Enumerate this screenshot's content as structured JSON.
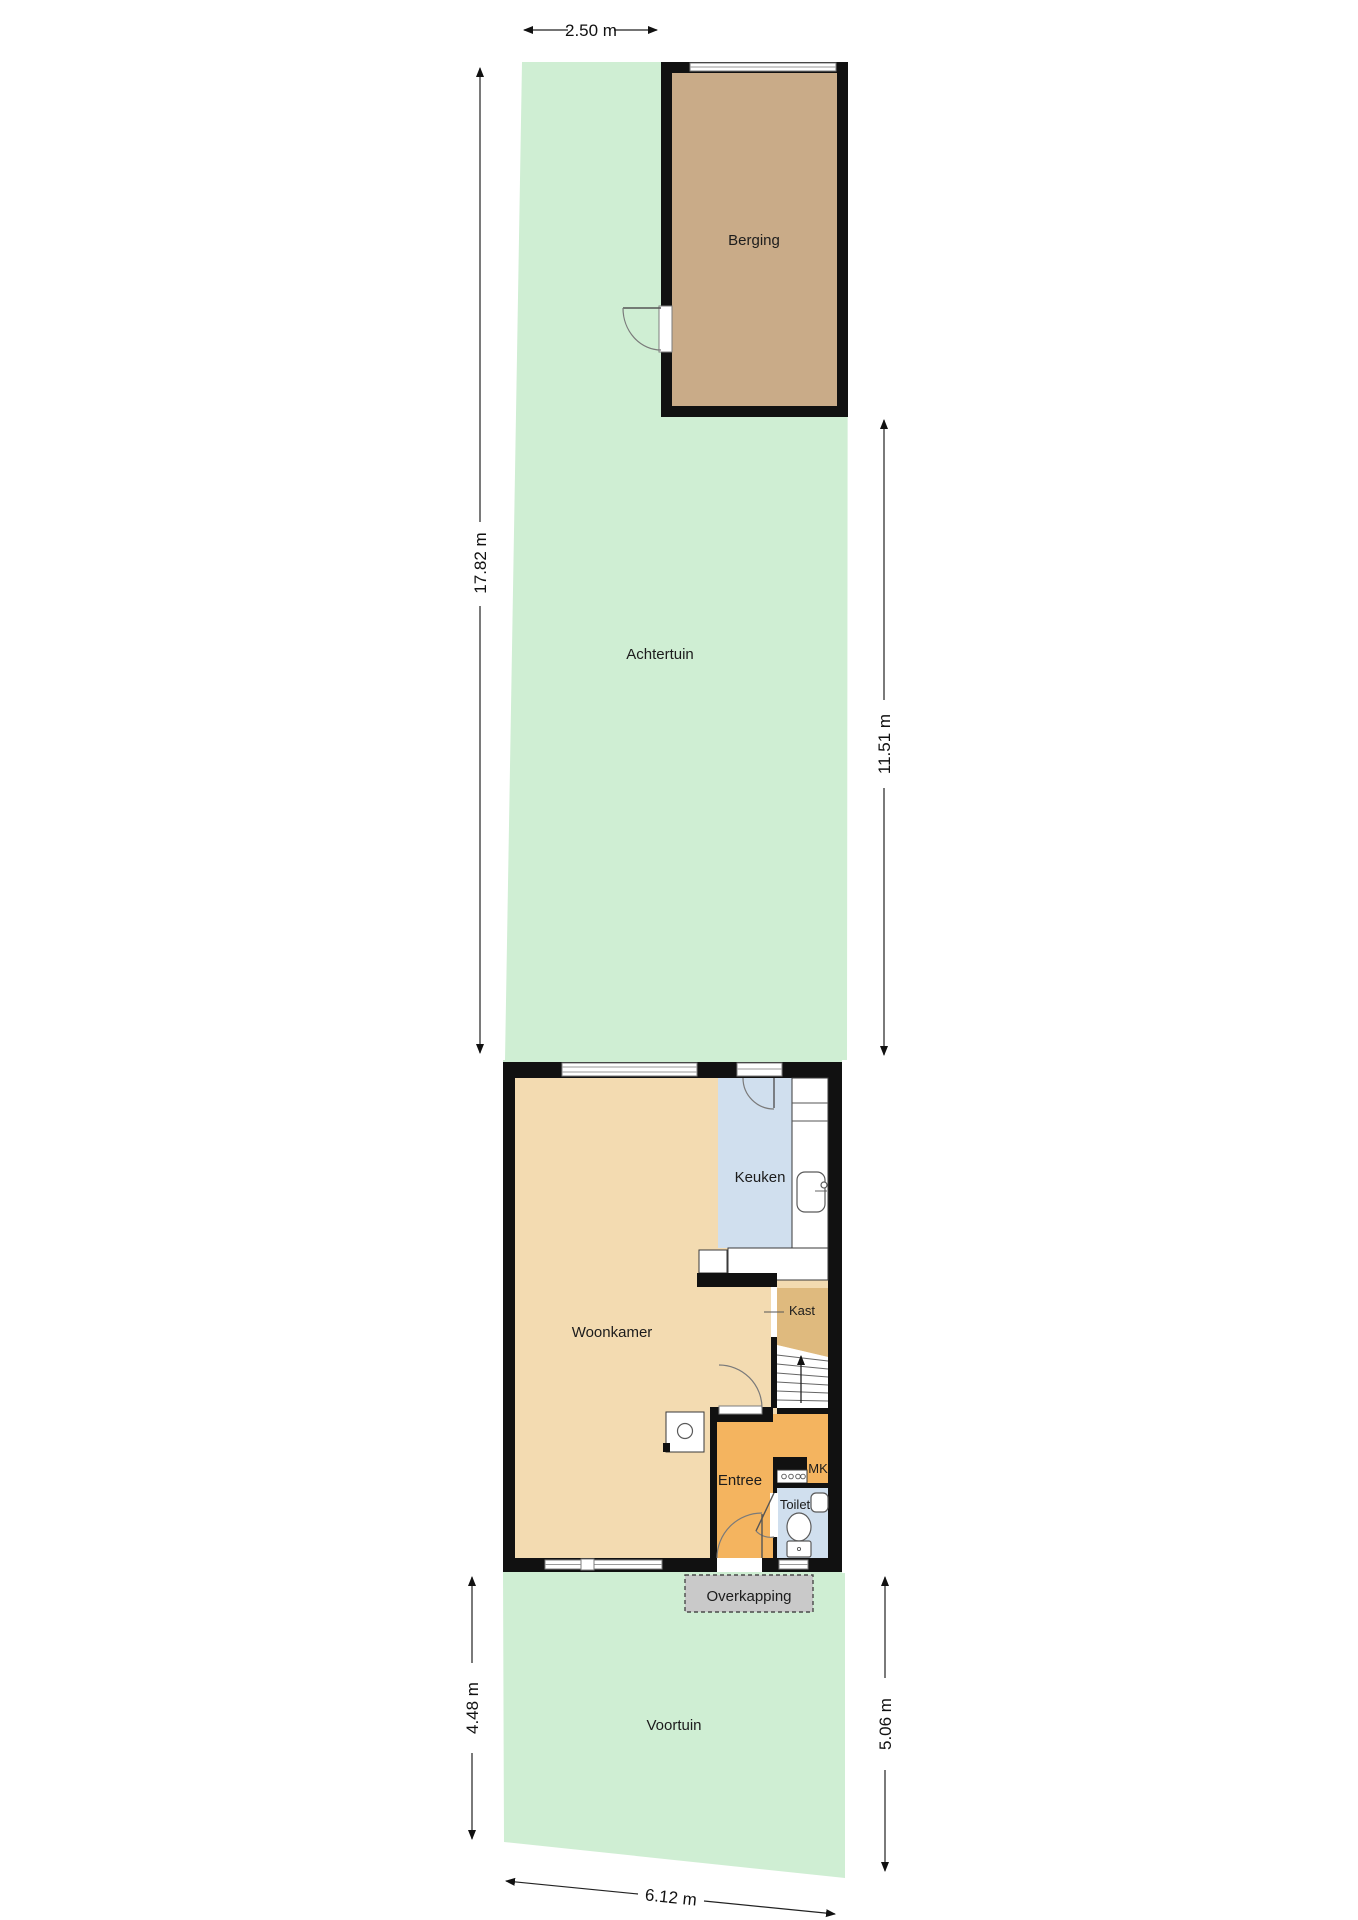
{
  "rooms": {
    "berging": "Berging",
    "achtertuin": "Achtertuin",
    "keuken": "Keuken",
    "woonkamer": "Woonkamer",
    "kast": "Kast",
    "entree": "Entree",
    "meterkast": "MK",
    "toilet": "Toilet",
    "overkapping": "Overkapping",
    "voortuin": "Voortuin"
  },
  "dimensions": {
    "back_passage_width": "2.50 m",
    "back_garden_depth_left": "17.82 m",
    "back_garden_depth_right": "11.51 m",
    "front_garden_depth_left": "4.48 m",
    "front_garden_depth_right": "5.06 m",
    "front_garden_width": "6.12 m"
  },
  "colors": {
    "garden": "#cfeed3",
    "berging": "#c9ab88",
    "woonkamer": "#f3dbb1",
    "keuken": "#d0dfee",
    "toilet": "#d0dfee",
    "kast": "#dfba7e",
    "entree": "#f4b45f",
    "overkapping": "#c9c9c9",
    "wall": "#111111"
  }
}
